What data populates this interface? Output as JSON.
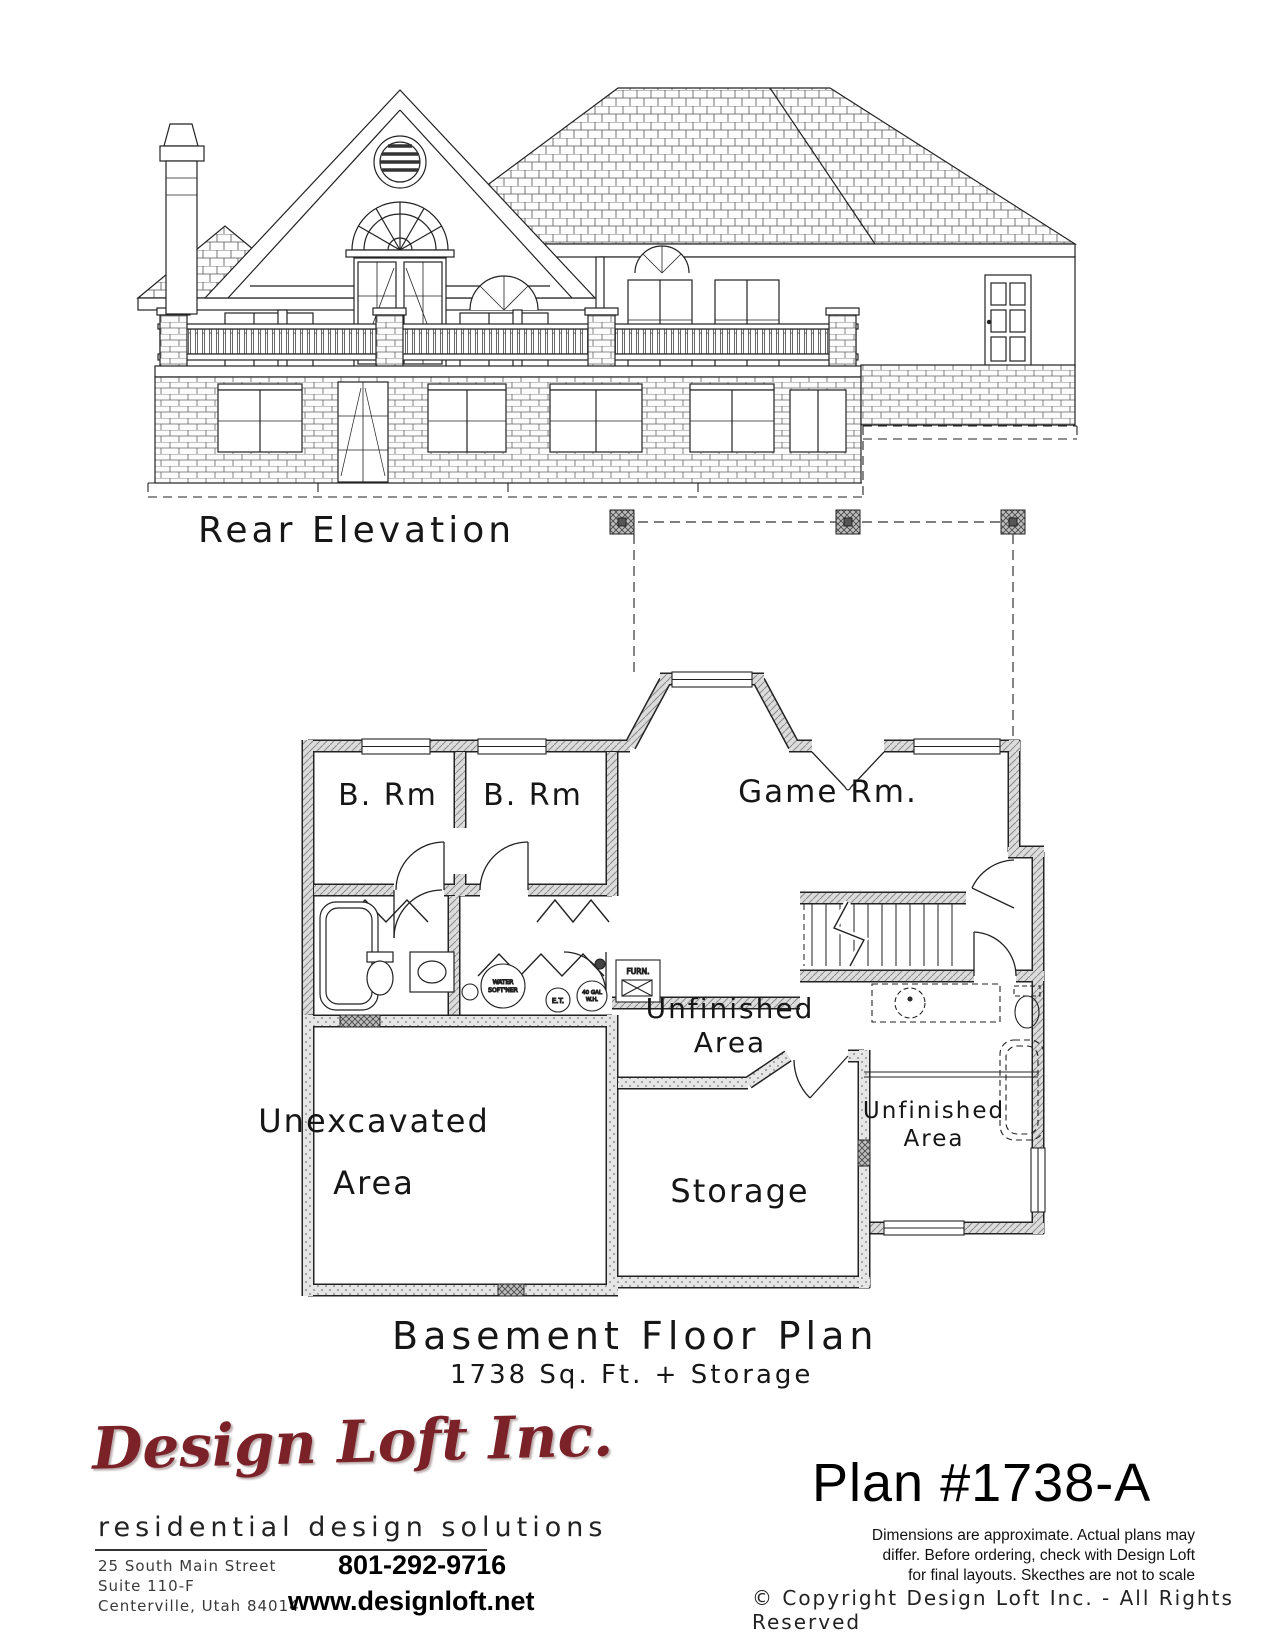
{
  "elevation": {
    "caption": "Rear Elevation"
  },
  "plan": {
    "caption": "Basement Floor Plan",
    "subcaption": "1738 Sq. Ft. + Storage",
    "rooms": {
      "bedroom_left": "B. Rm",
      "bedroom_right": "B. Rm",
      "game_room": "Game Rm.",
      "unfinished_center_1": "Unfinished",
      "unfinished_center_2": "Area",
      "unexcavated_1": "Unexcavated",
      "unexcavated_2": "Area",
      "unfinished_right_1": "Unfinished",
      "unfinished_right_2": "Area",
      "storage": "Storage"
    },
    "equipment": {
      "furnace": "FURN.",
      "water_softener_1": "WATER",
      "water_softener_2": "SOFT'NER",
      "expansion_tank": "E.T.",
      "water_heater_1": "40 GAL",
      "water_heater_2": "W.H."
    }
  },
  "footer": {
    "logo": "Design Loft Inc.",
    "tagline": "residential design solutions",
    "address": [
      "25 South Main Street",
      "Suite 110-F",
      "Centerville, Utah 84014"
    ],
    "phone": "801-292-9716",
    "website": "www.designloft.net",
    "plan_number": "Plan #1738-A",
    "disclaimer": [
      "Dimensions are approximate.  Actual plans may",
      "differ.  Before ordering, check with Design Loft",
      "for final layouts.  Skecthes are not to scale"
    ],
    "copyright": "©  Copyright Design Loft Inc. - All Rights Reserved"
  },
  "colors": {
    "logo": "#7b2128",
    "ink": "#1a1a1a"
  }
}
